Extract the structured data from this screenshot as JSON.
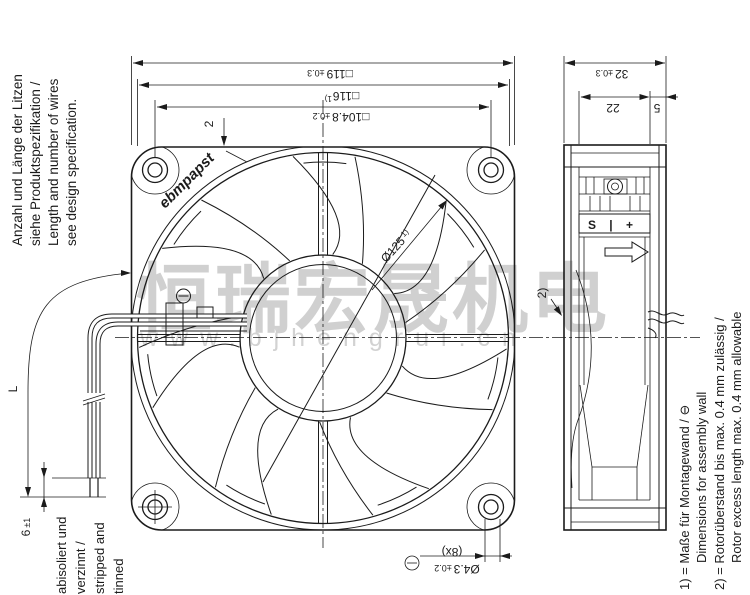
{
  "drawing": {
    "brand_logo": "ebmpapst",
    "watermark": {
      "chinese": "恒瑞宏晟机电",
      "url": "www.bjhengrui.cn"
    },
    "wire_note": {
      "line1": "Anzahl und Länge der Litzen",
      "line2": "siehe Produktspezifikation /",
      "line3": "Length and number of wires",
      "line4": "see design specification."
    },
    "strip_note": {
      "line1": "abisoliert und",
      "line2": "verzinnt /",
      "line3": "stripped and",
      "line4": "tinned"
    },
    "footnotes": {
      "n1_de": "1) = Maße für Montagewand / ⊖",
      "n1_en": "Dimensions for assembly wall",
      "n2_de": "2) = Rotorüberstand bis max. 0.4 mm zulässig /",
      "n2_en": "Rotor excess length max. 0.4 mm allowable"
    },
    "dims": {
      "frame_size": {
        "v": "□119",
        "tol": "±0.3"
      },
      "wall_size": {
        "v": "□116",
        "ref": "1)"
      },
      "hole_spacing": {
        "v": "□104.8",
        "tol": "±0.2"
      },
      "lip": "2",
      "rotor_dia": {
        "v": "Ø125",
        "ref": "1)"
      },
      "depth": {
        "v": "32",
        "tol": "±0.3"
      },
      "front_depth": "22",
      "rear_depth": "5",
      "hole_dia": {
        "v": "Ø4.3",
        "tol": "±0.2",
        "count": "(8x)"
      },
      "strip": {
        "v": "6",
        "tol": "±1"
      },
      "wire_length": "L",
      "ref2": "2)"
    },
    "markings": {
      "terminals": "S | +"
    }
  }
}
